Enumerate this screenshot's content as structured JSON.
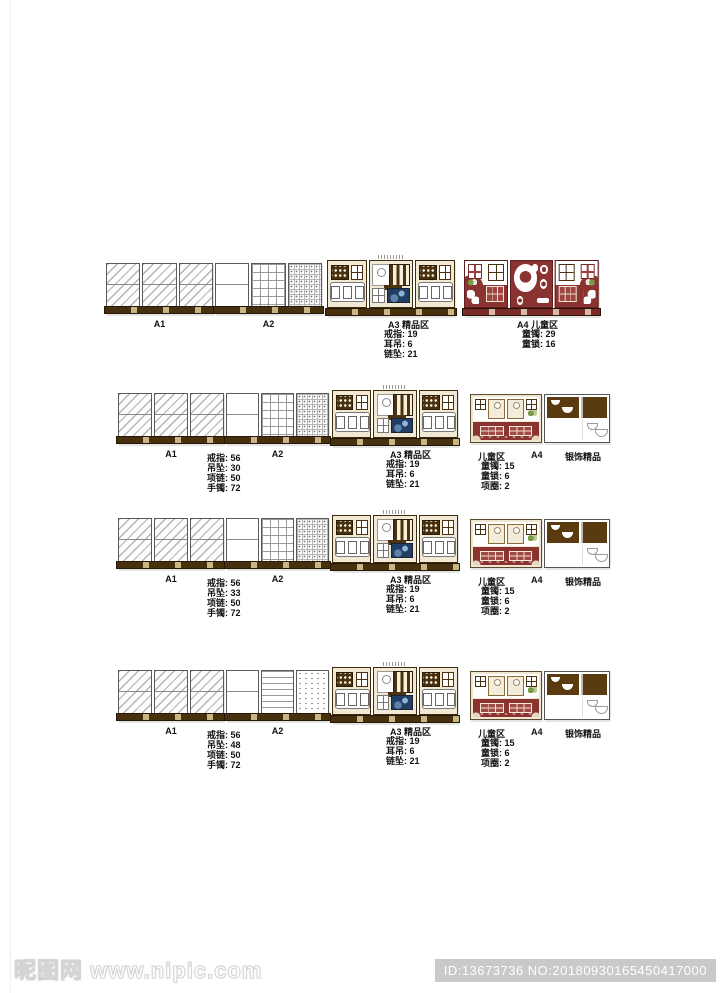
{
  "colors": {
    "wood_brown": "#46300e",
    "cream": "#f1e9d3",
    "maroon": "#8b3331",
    "silver_box_brown": "#5a3a10"
  },
  "watermark": {
    "site": "昵图网 www.nipic.com",
    "badge": "ID:13673736 NO:20180930165450417000"
  },
  "rows": [
    {
      "a1": "A1",
      "a2": "A2",
      "a3_title": "A3 精品区",
      "a3_items": [
        "戒指: 19",
        "耳吊: 6",
        "链坠: 21"
      ],
      "a4_title": "A4 儿童区",
      "a4_items": [
        "童镯: 29",
        "童锁: 16"
      ]
    },
    {
      "a1": "A1",
      "a2": "A2",
      "counts": [
        "戒指: 56",
        "吊坠: 30",
        "项链: 50",
        "手镯: 72"
      ],
      "a3_title": "A3 精品区",
      "a3_items": [
        "戒指: 19",
        "耳吊: 6",
        "链坠: 21"
      ],
      "kids_label": "儿童区",
      "a4": "A4",
      "kids_items": [
        "童镯: 15",
        "童锁: 6",
        "项圈: 2"
      ],
      "silver_label": "银饰精品"
    },
    {
      "a1": "A1",
      "a2": "A2",
      "counts": [
        "戒指: 56",
        "吊坠: 33",
        "项链: 50",
        "手镯: 72"
      ],
      "a3_title": "A3 精品区",
      "a3_items": [
        "戒指: 19",
        "耳吊: 6",
        "链坠: 21"
      ],
      "kids_label": "儿童区",
      "a4": "A4",
      "kids_items": [
        "童镯: 15",
        "童锁: 6",
        "项圈: 2"
      ],
      "silver_label": "银饰精品"
    },
    {
      "a1": "A1",
      "a2": "A2",
      "counts": [
        "戒指: 56",
        "吊坠: 48",
        "项链: 50",
        "手镯: 72"
      ],
      "a3_title": "A3 精品区",
      "a3_items": [
        "戒指: 19",
        "耳吊: 6",
        "链坠: 21"
      ],
      "kids_label": "儿童区",
      "a4": "A4",
      "kids_items": [
        "童镯: 15",
        "童锁: 6",
        "项圈: 2"
      ],
      "silver_label": "银饰精品"
    }
  ]
}
